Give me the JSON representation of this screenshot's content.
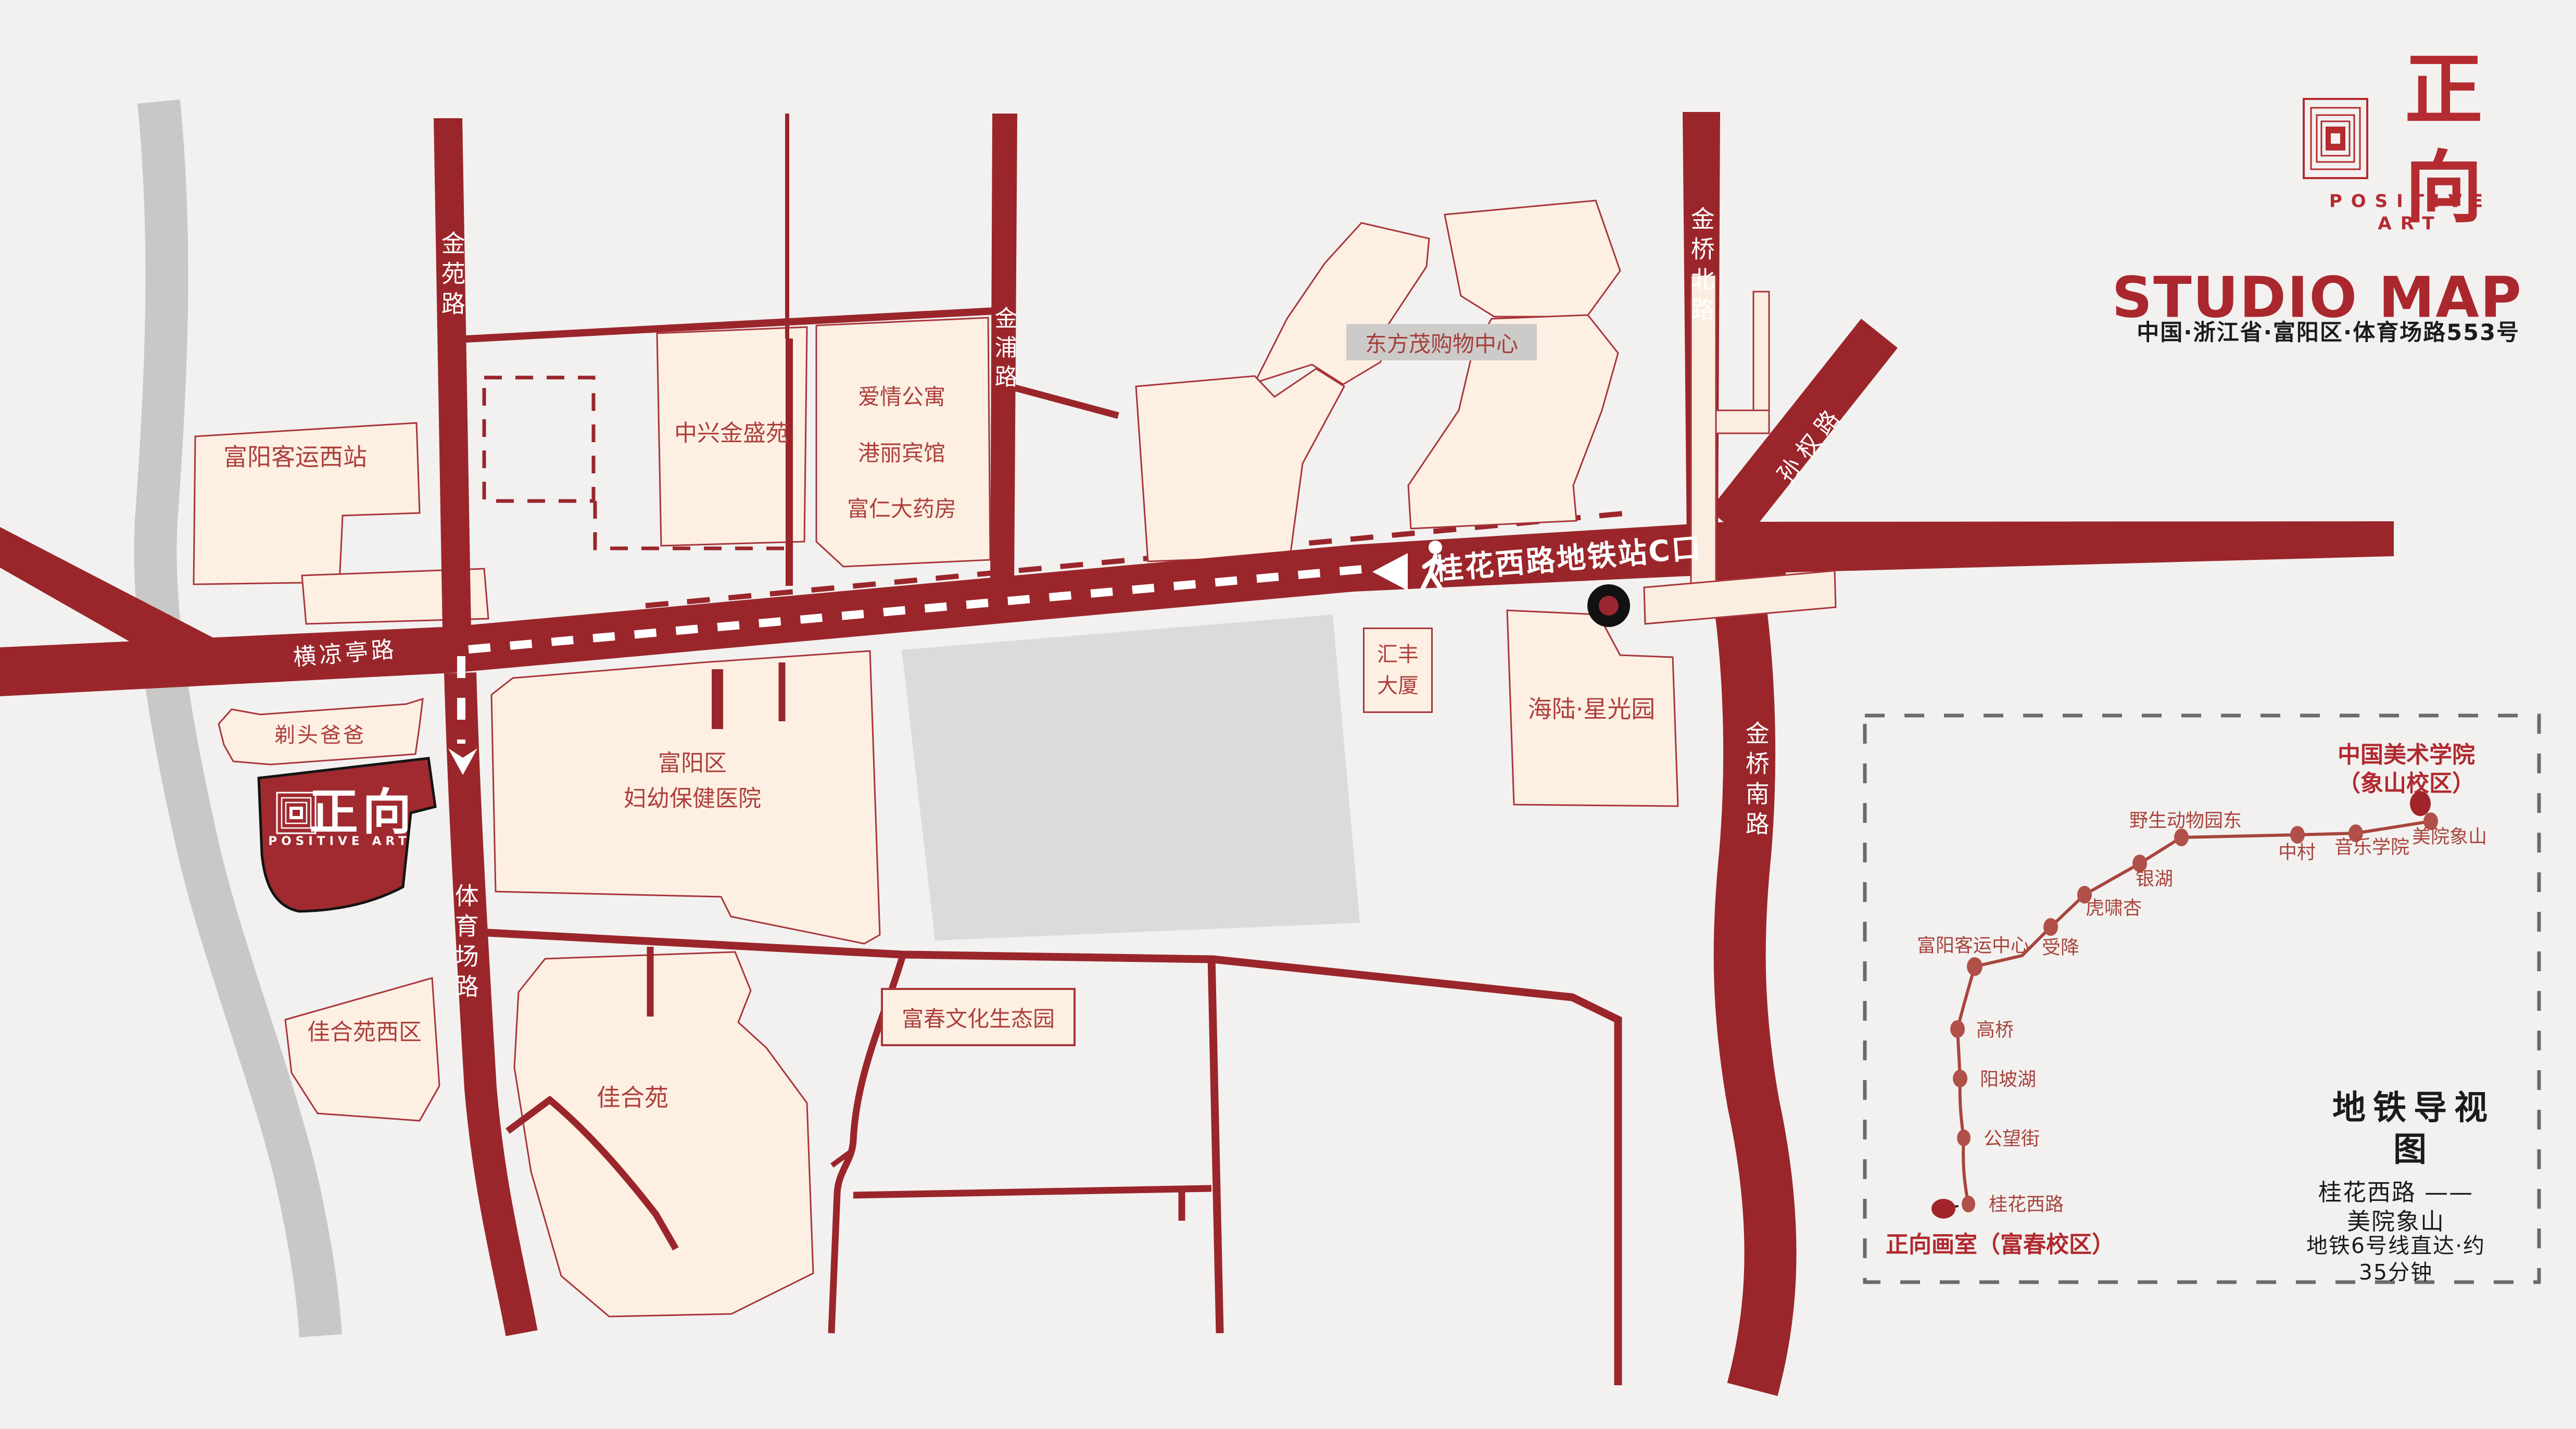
{
  "brand": {
    "name": "正向",
    "subtitle": "POSITIVE ART",
    "title": "STUDIO MAP",
    "address": "中国·浙江省·富阳区·体育场路553号"
  },
  "map": {
    "roads": {
      "jinyuan": "金苑路",
      "jinpu": "金浦路",
      "jinqiao_north": "金桥北路",
      "sunquan": "孙权路",
      "jinqiao_south": "金桥南路",
      "tiyuchang": "体育场路",
      "henglianting": "横凉亭路"
    },
    "station_exit_label": "桂花西路地铁站C口",
    "places": {
      "fuyang_west_bus": "富阳客运西站",
      "zhongxing": "中兴金盛苑",
      "apartments": "爱情公寓\n\n港丽宾馆\n\n富仁大药房",
      "dongfangmao": "东方茂购物中心",
      "huifeng": "汇丰\n大厦",
      "hailu": "海陆·星光园",
      "hospital": "富阳区\n妇幼保健医院",
      "titou": "剃头爸爸",
      "jiaheyuan_west": "佳合苑西区",
      "jiaheyuan": "佳合苑",
      "fuchun_park": "富春文化生态园"
    }
  },
  "metro": {
    "title": "地铁导视图",
    "route": "桂花西路 —— 美院象山",
    "duration": "地铁6号线直达·约35分钟",
    "start": "正向画室（富春校区）",
    "end": "中国美术学院（象山校区）",
    "stations": [
      "桂花西路",
      "公望街",
      "阳坡湖",
      "高桥",
      "富阳客运中心",
      "受降",
      "虎啸杏",
      "银湖",
      "野生动物园东",
      "中村",
      "音乐学院",
      "美院象山"
    ]
  },
  "colors": {
    "background": "#f2f1f0",
    "road_red": "#9a262b",
    "building_fill": "#fdf0e3",
    "building_stroke": "#a8353a",
    "building_text": "#ad403d",
    "brand_red": "#b42b30",
    "title_red": "#ab272e",
    "studio_fill": "#a02a30",
    "gray_block": "#dcdbda",
    "gray_road": "#c9c8c7",
    "metro_line": "#a8453e",
    "metro_dot": "#b05048",
    "metro_big_dot": "#a2242b",
    "dash_border": "#6b6b6b",
    "text_black": "#1c1b1a"
  }
}
